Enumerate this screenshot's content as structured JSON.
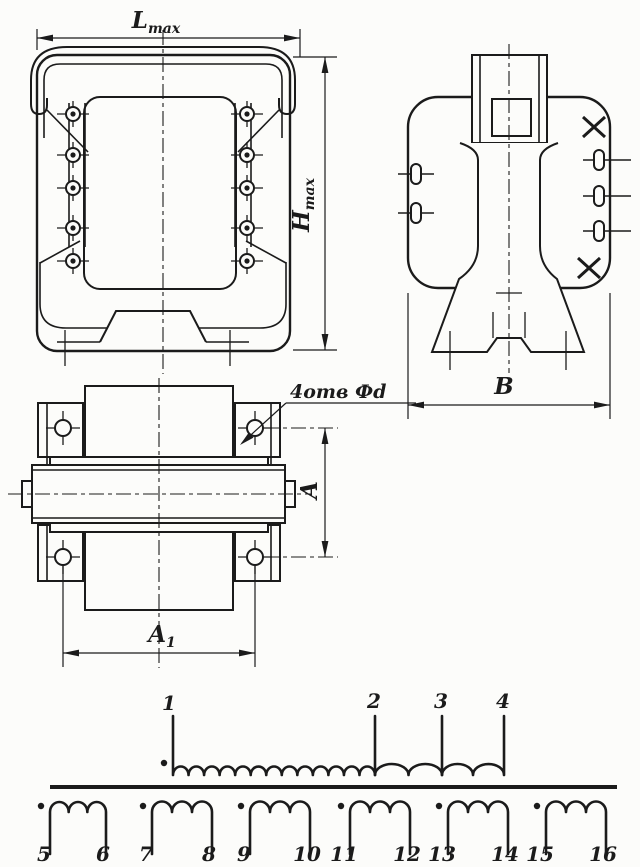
{
  "colors": {
    "ink": "#1b1b1b",
    "paper": "#fcfcfa"
  },
  "views": {
    "front": {
      "dim_width": {
        "base": "L",
        "sub": "max"
      },
      "dim_height": {
        "base": "H",
        "sub": "max"
      }
    },
    "side": {
      "dim_width": {
        "base": "B",
        "sub": ""
      }
    },
    "plan": {
      "dim_height": {
        "base": "A",
        "sub": ""
      },
      "dim_width": {
        "base": "A",
        "sub": "1"
      },
      "holes_note": "4отв Фd"
    }
  },
  "schematic": {
    "primary": {
      "terminals": [
        "1",
        "2",
        "3",
        "4"
      ],
      "turns_sections": [
        13,
        2,
        2
      ]
    },
    "secondaries": {
      "turns_each": 3,
      "windings": [
        {
          "start": "5",
          "end": "6"
        },
        {
          "start": "7",
          "end": "8"
        },
        {
          "start": "9",
          "end": "10"
        },
        {
          "start": "11",
          "end": "12"
        },
        {
          "start": "13",
          "end": "14"
        },
        {
          "start": "15",
          "end": "16"
        }
      ]
    }
  }
}
